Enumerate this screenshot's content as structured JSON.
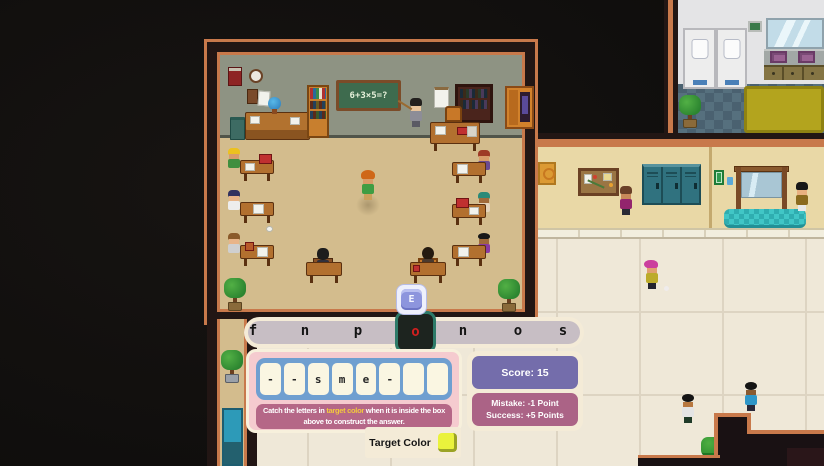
{
  "scene": {
    "blackboard_equation": "6+3×5=?",
    "key_prompt": "E"
  },
  "letter_bar": {
    "letters": [
      "f",
      "n",
      "p",
      "o",
      "n",
      "o",
      "s"
    ],
    "boxed_index": 3
  },
  "answer": {
    "tiles": [
      "-",
      "-",
      "s",
      "m",
      "e",
      "-",
      "",
      ""
    ]
  },
  "instruction": {
    "before": "Catch the letters in ",
    "highlight": "target color",
    "after": " when it is inside the box above to construct the answer."
  },
  "score": {
    "label": "Score: 15",
    "mistake": "Mistake: -1 Point",
    "success": "Success: +5 Points"
  },
  "target": {
    "label": "Target Color",
    "swatch_color": "#eaf23c"
  },
  "colors": {
    "boxed_letter": "#d01f1f",
    "box_border": "#2d7a68",
    "highlight_text": "#f2c83e",
    "score_badge_bg": "#746dab",
    "rules_badge_bg": "#ab6386",
    "answer_panel_bg": "#f5cbcf",
    "tiles_container_bg": "#6f9fd0",
    "letter_bar_fill": "#c7bec4",
    "ui_cream": "#f4ebd7"
  }
}
